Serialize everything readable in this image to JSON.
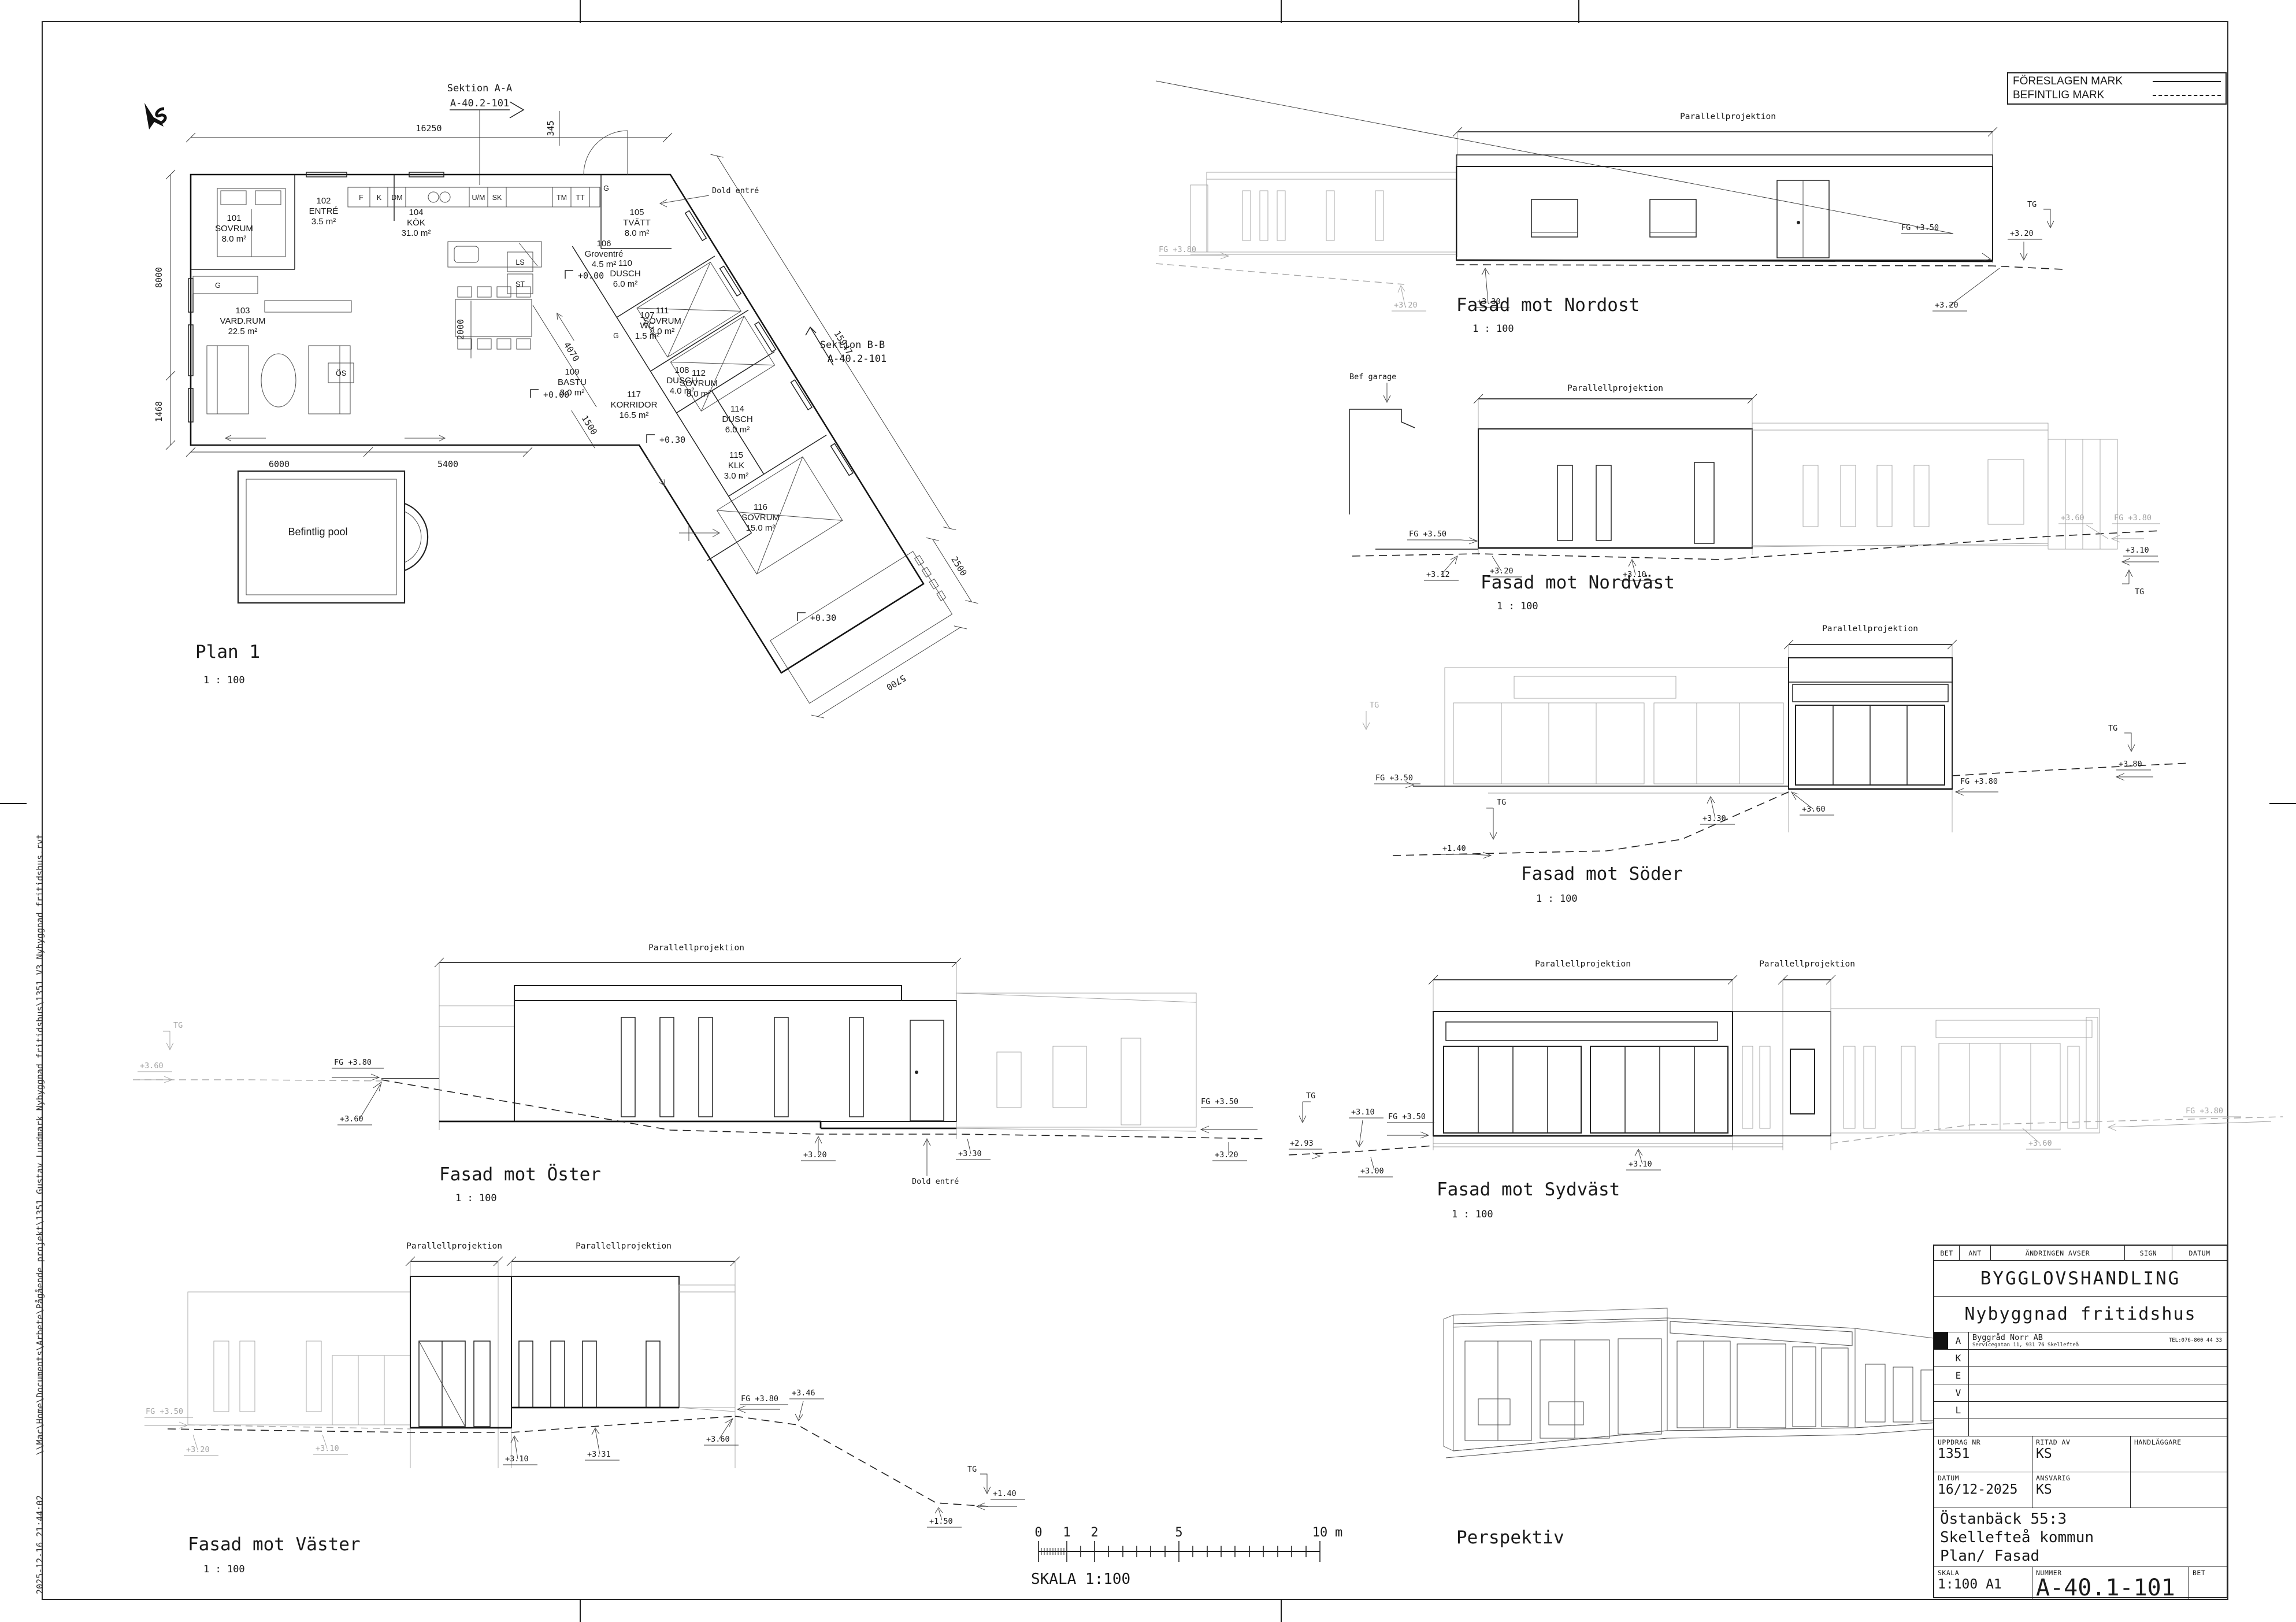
{
  "sheet": {
    "file_path": "\\\\Mac\\Home\\Documents\\Arbete\\Pågående projekt\\1351 Gustav Lundmark Nybyggnad fritidshus\\1351 V3 Nybyggnad fritidshus.rvt",
    "timestamp": "2025-12-16 21:44:02"
  },
  "legend": {
    "proposed": "FÖRESLAGEN MARK",
    "existing": "BEFINTLIG MARK"
  },
  "plan": {
    "title": "Plan 1",
    "scale": "1 : 100",
    "section_a": [
      "Sektion A-A",
      "A-40.2-101"
    ],
    "section_b": [
      "Sektion B-B",
      "A-40.2-101"
    ],
    "pool": "Befintlig pool",
    "dold_entre": "Dold entré",
    "levels": {
      "zero_a": "+0.00",
      "zero_b": "+0.00",
      "p30_a": "+0.30",
      "p30_b": "+0.30"
    },
    "dims": {
      "top": "16250",
      "left_a": "8000",
      "left_b": "1468",
      "entry": "345",
      "bottom_a": "6000",
      "bottom_b": "5400",
      "hall": "2000",
      "corridor": "4070",
      "wing": "15947",
      "wing_end": "2500",
      "deck": "5700",
      "bastu": "1500"
    },
    "fixtures": {
      "f": "F",
      "k": "K",
      "dm": "DM",
      "um": "U/M",
      "sk": "SK",
      "tm": "TM",
      "tt": "TT",
      "ls": "LS",
      "st": "ST",
      "g1": "G",
      "g2": "G",
      "g3": "G",
      "os": "ÖS"
    },
    "rooms": [
      {
        "num": "101",
        "name": "SOVRUM",
        "area": "8.0 m²"
      },
      {
        "num": "102",
        "name": "ENTRÉ",
        "area": "3.5 m²"
      },
      {
        "num": "103",
        "name": "VARD.RUM",
        "area": "22.5 m²"
      },
      {
        "num": "104",
        "name": "KÖK",
        "area": "31.0 m²"
      },
      {
        "num": "105",
        "name": "TVÄTT",
        "area": "8.0 m²"
      },
      {
        "num": "106",
        "name": "Groventré",
        "area": "4.5 m²"
      },
      {
        "num": "107",
        "name": "WC",
        "area": "1.5 m²"
      },
      {
        "num": "108",
        "name": "DUSCH",
        "area": "4.0 m²"
      },
      {
        "num": "109",
        "name": "BASTU",
        "area": "3.0 m²"
      },
      {
        "num": "110",
        "name": "DUSCH",
        "area": "6.0 m²"
      },
      {
        "num": "111",
        "name": "SOVRUM",
        "area": "8.0 m²"
      },
      {
        "num": "112",
        "name": "SOVRUM",
        "area": "8.0 m²"
      },
      {
        "num": "114",
        "name": "DUSCH",
        "area": "6.0 m²"
      },
      {
        "num": "115",
        "name": "KLK",
        "area": "3.0 m²"
      },
      {
        "num": "116",
        "name": "SOVRUM",
        "area": "15.0 m²"
      },
      {
        "num": "117",
        "name": "KORRIDOR",
        "area": "16.5 m²"
      }
    ]
  },
  "facades": {
    "projection_label": "Parallellprojektion",
    "nordost": {
      "title": "Fasad mot Nordost",
      "scale": "1 : 100",
      "fg_left": "FG +3.80",
      "lv_320_left": "+3.20",
      "lv_330": "+3.30",
      "fg_right": "FG +3.50",
      "lv_320_mid": "+3.20",
      "lv_320_right": "+3.20",
      "tg": "TG"
    },
    "nordvast": {
      "title": "Fasad mot Nordväst",
      "scale": "1 : 100",
      "bef_garage": "Bef garage",
      "fg_left": "FG +3.50",
      "lv_312": "+3.12",
      "lv_320": "+3.20",
      "lv_310": "+3.10",
      "lv_360": "+3.60",
      "fg_right": "FG +3.80",
      "lv_310_right": "+3.10",
      "tg": "TG"
    },
    "soder": {
      "title": "Fasad mot Söder",
      "scale": "1 : 100",
      "tg_left": "TG",
      "fg_left": "FG +3.50",
      "tg_mid": "TG",
      "lv_140": "+1.40",
      "lv_330": "+3.30",
      "lv_360": "+3.60",
      "fg_right": "FG +3.80",
      "lv_380": "+3.80",
      "tg_right": "TG"
    },
    "oster": {
      "title": "Fasad mot Öster",
      "scale": "1 : 100",
      "tg_left": "TG",
      "lv_360_left": "+3.60",
      "fg_left": "FG +3.80",
      "lv_360": "+3.60",
      "lv_320": "+3.20",
      "dold_entre": "Dold entré",
      "lv_330": "+3.30",
      "fg_right": "FG +3.50",
      "lv_320_right": "+3.20"
    },
    "sydvast": {
      "title": "Fasad mot Sydväst",
      "scale": "1 : 100",
      "tg": "TG",
      "lv_310_left": "+3.10",
      "fg_left": "FG +3.50",
      "lv_293": "+2.93",
      "lv_300": "+3.00",
      "lv_310": "+3.10",
      "lv_360": "+3.60",
      "fg_right": "FG +3.80"
    },
    "vaster": {
      "title": "Fasad mot Väster",
      "scale": "1 : 100",
      "fg_left": "FG +3.50",
      "lv_320": "+3.20",
      "lv_310_a": "+3.10",
      "lv_310_b": "+3.10",
      "lv_331": "+3.31",
      "lv_360": "+3.60",
      "fg_right": "FG +3.80",
      "lv_346": "+3.46",
      "tg": "TG",
      "lv_140": "+1.40",
      "lv_150": "+1.50"
    }
  },
  "perspective": {
    "title": "Perspektiv"
  },
  "scalebar": {
    "t0": "0",
    "t1": "1",
    "t2": "2",
    "t5": "5",
    "t10": "10",
    "unit": "m",
    "label": "SKALA 1:100"
  },
  "titleblock": {
    "rev": {
      "bet": "BET",
      "ant": "ANT",
      "andringen": "ÄNDRINGEN AVSER",
      "sign": "SIGN",
      "datum": "DATUM"
    },
    "doc_type": "BYGGLOVSHANDLING",
    "project": "Nybyggnad fritidshus",
    "company": {
      "name": "Byggråd Norr AB",
      "address": "Servicegatan 11, 931 76 Skellefteå",
      "tel": "TEL:076-800 44 33"
    },
    "disciplines": {
      "a": "A",
      "k": "K",
      "e": "E",
      "v": "V",
      "l": "L"
    },
    "fields": {
      "uppdrag_label": "UPPDRAG NR",
      "uppdrag": "1351",
      "ritad_label": "RITAD AV",
      "ritad": "KS",
      "handlaggare_label": "HANDLÄGGARE",
      "datum_label": "DATUM",
      "datum": "16/12-2025",
      "ansvarig_label": "ANSVARIG",
      "ansvarig": "KS"
    },
    "object": {
      "line1": "Östanbäck 55:3",
      "line2": "Skellefteå kommun",
      "line3": "Plan/ Fasad"
    },
    "skala_label": "SKALA",
    "skala": "1:100  A1",
    "nummer_label": "NUMMER",
    "nummer": "A-40.1-101",
    "bet_label": "BET"
  }
}
